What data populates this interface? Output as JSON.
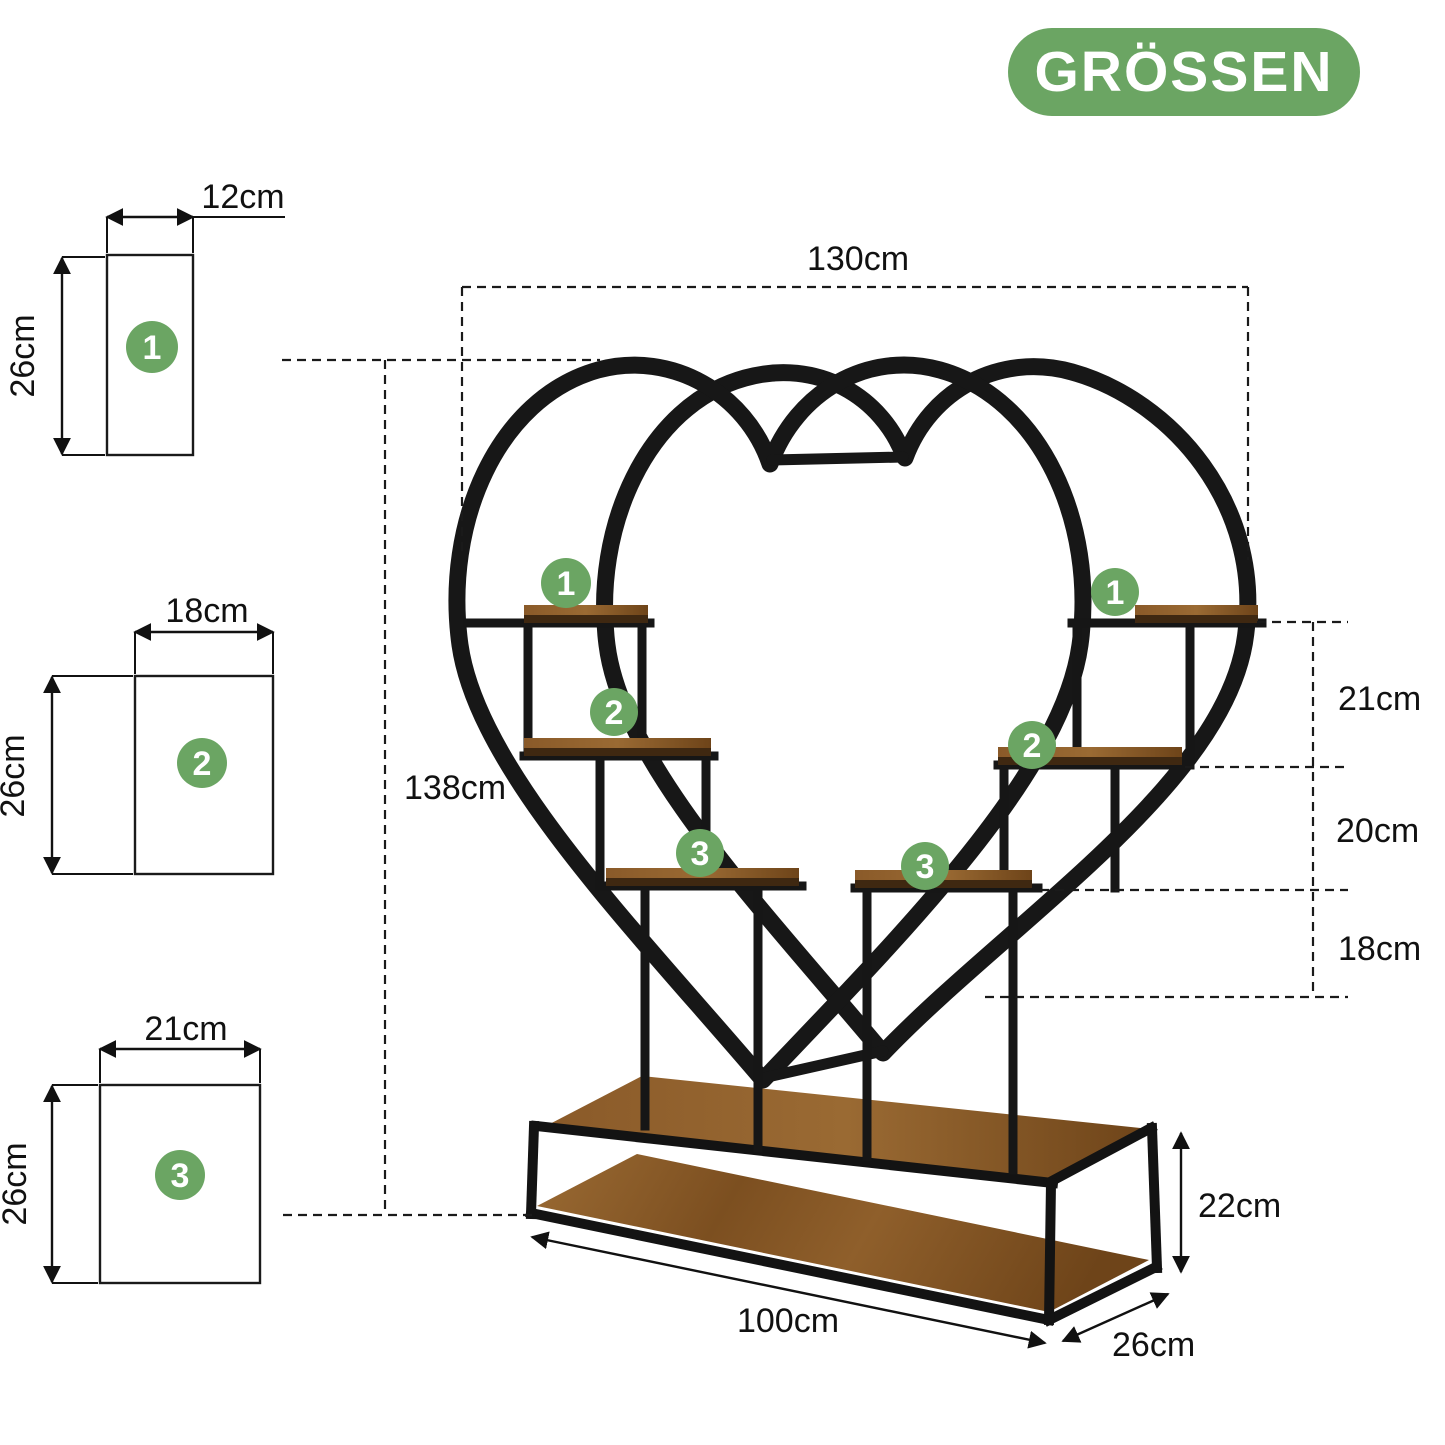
{
  "badge": {
    "label": "GRÖSSEN"
  },
  "labels": {
    "total_width": "130cm",
    "height": "138cm",
    "tier1_gap": "21cm",
    "tier2_gap": "20cm",
    "tier3_gap": "18cm",
    "base_length": "100cm",
    "base_depth": "26cm",
    "base_height": "22cm"
  },
  "size_diagrams": [
    {
      "num": "1",
      "width": "12cm",
      "height": "26cm"
    },
    {
      "num": "2",
      "width": "18cm",
      "height": "26cm"
    },
    {
      "num": "3",
      "width": "21cm",
      "height": "26cm"
    }
  ],
  "markers": {
    "left": [
      "1",
      "2",
      "3"
    ],
    "right": [
      "1",
      "2",
      "3"
    ]
  },
  "colors": {
    "green": "#6BA563",
    "wood_light": "#9A6A33",
    "wood_dark": "#6E4419",
    "metal": "#171717",
    "line": "#111111"
  }
}
